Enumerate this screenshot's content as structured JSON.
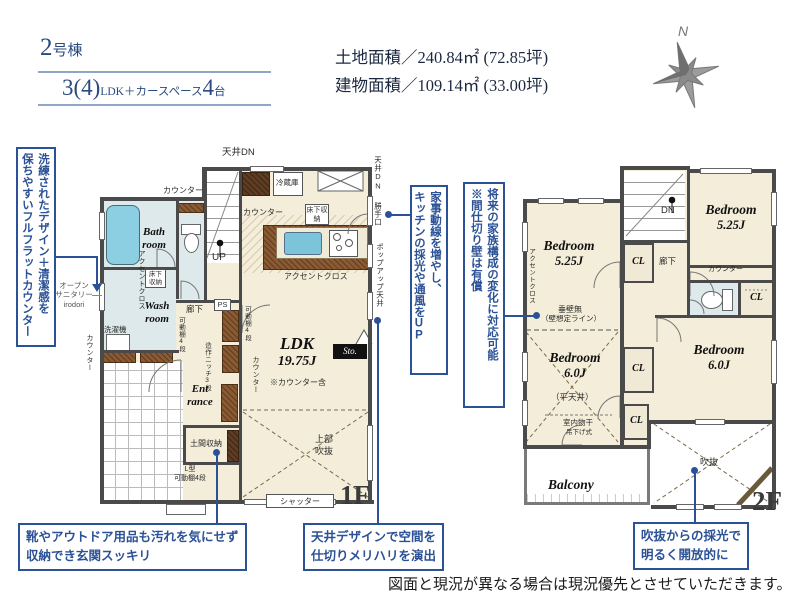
{
  "header": {
    "building_num": "2",
    "building_suffix": "号棟",
    "layout_num": "3(4)",
    "layout_mid": "LDK＋カースペース",
    "layout_count": "4",
    "layout_unit": "台",
    "land_area": "土地面積／240.84㎡ (72.85坪)",
    "building_area": "建物面積／109.14㎡ (33.00坪)",
    "compass": "N"
  },
  "callouts": {
    "flat_counter": {
      "col1": "洗練されたデザイン＋清潔感を",
      "col2": "保ちやすいフルフラットカウンター"
    },
    "kaji_dousen": {
      "col1": "家事動線を増やし、",
      "col2": "キッチンの採光や通風をUP"
    },
    "partition": {
      "col1": "将来の家族構成の変化に対応可能",
      "col2": "※間仕切り壁は有償"
    },
    "genkan": {
      "line1": "靴やアウトドア用品も汚れを気にせず",
      "line2": "収納でき玄関スッキリ"
    },
    "ceiling": {
      "line1": "天井デザインで空間を",
      "line2": "仕切りメリハリを演出"
    },
    "fukinuke": {
      "line1": "吹抜からの採光で",
      "line2": "明るく開放的に"
    }
  },
  "plan1f": {
    "floor": "1F",
    "rooms": {
      "bath": {
        "l1": "Bath",
        "l2": "room"
      },
      "wash": {
        "l1": "Wash",
        "l2": "room"
      },
      "entrance": {
        "l1": "Ent",
        "l2": "rance"
      },
      "ldk": {
        "name": "LDK",
        "size": "19.75J",
        "note": "※カウンター含"
      },
      "sto": "Sto.",
      "jyoubu": {
        "l1": "上部",
        "l2": "吹抜"
      }
    },
    "labels": {
      "tenjo_dn": "天井DN",
      "counter1": "カウンター",
      "reizouko": "冷蔵庫",
      "counter2": "カウンター",
      "yukashita1": "床下収納",
      "accent1": "アクセントクロス",
      "up": "UP",
      "yukashita2": "床下収納",
      "accent2": "アクセントクロス",
      "open_sanitary": {
        "l1": "オープン",
        "l2": "サニタリー",
        "l3": "irodori"
      },
      "sentakuki": "洗濯機",
      "counter3": "カウンター",
      "rouka": "廊下",
      "ps": "PS",
      "kadoudana1": "可動棚4段",
      "zousaku": "造作ニッチ3段",
      "kadoudana2": "可動棚4段",
      "doma": "土間収納",
      "lgata": {
        "l1": "L型",
        "l2": "可動棚4段"
      },
      "counter4": "カウンター",
      "shutter": "シャッター",
      "tenjo_dn2": "天井DN",
      "katteguchi": "勝手口",
      "popup": "ポップアップ天井"
    }
  },
  "plan2f": {
    "floor": "2F",
    "rooms": {
      "bedroom_nw": {
        "name": "Bedroom",
        "size": "5.25J"
      },
      "bedroom_ne": {
        "name": "Bedroom",
        "size": "5.25J"
      },
      "bedroom_sw": {
        "name": "Bedroom",
        "size": "6.0J"
      },
      "bedroom_se": {
        "name": "Bedroom",
        "size": "6.0J"
      },
      "balcony": "Balcony",
      "fukinuke": "吹抜"
    },
    "labels": {
      "dn": "DN",
      "accent": "アクセントクロス",
      "tarekabe": "垂壁無",
      "kabe_sentei": "（壁想定ライン）",
      "cl1": "CL",
      "cl2": "CL",
      "cl3": "CL",
      "cl4": "CL",
      "rouka": "廊下",
      "counter": "カウンター",
      "hiratenjo": "（平天井）",
      "monohoshi1": "室内物干",
      "monohoshi2": "吊下げ式"
    }
  },
  "footer": {
    "disclaimer": "図面と現況が異なる場合は現況優先とさせていただきます。"
  },
  "colors": {
    "accent_blue": "#2b5196",
    "wall": "#4a4a4a",
    "floor_cream": "#f3edd9",
    "wet_area": "#dde9ea",
    "wood": "#8a5a33",
    "tub": "#8ccfe2",
    "compass_gray": "#8a8a8a"
  }
}
